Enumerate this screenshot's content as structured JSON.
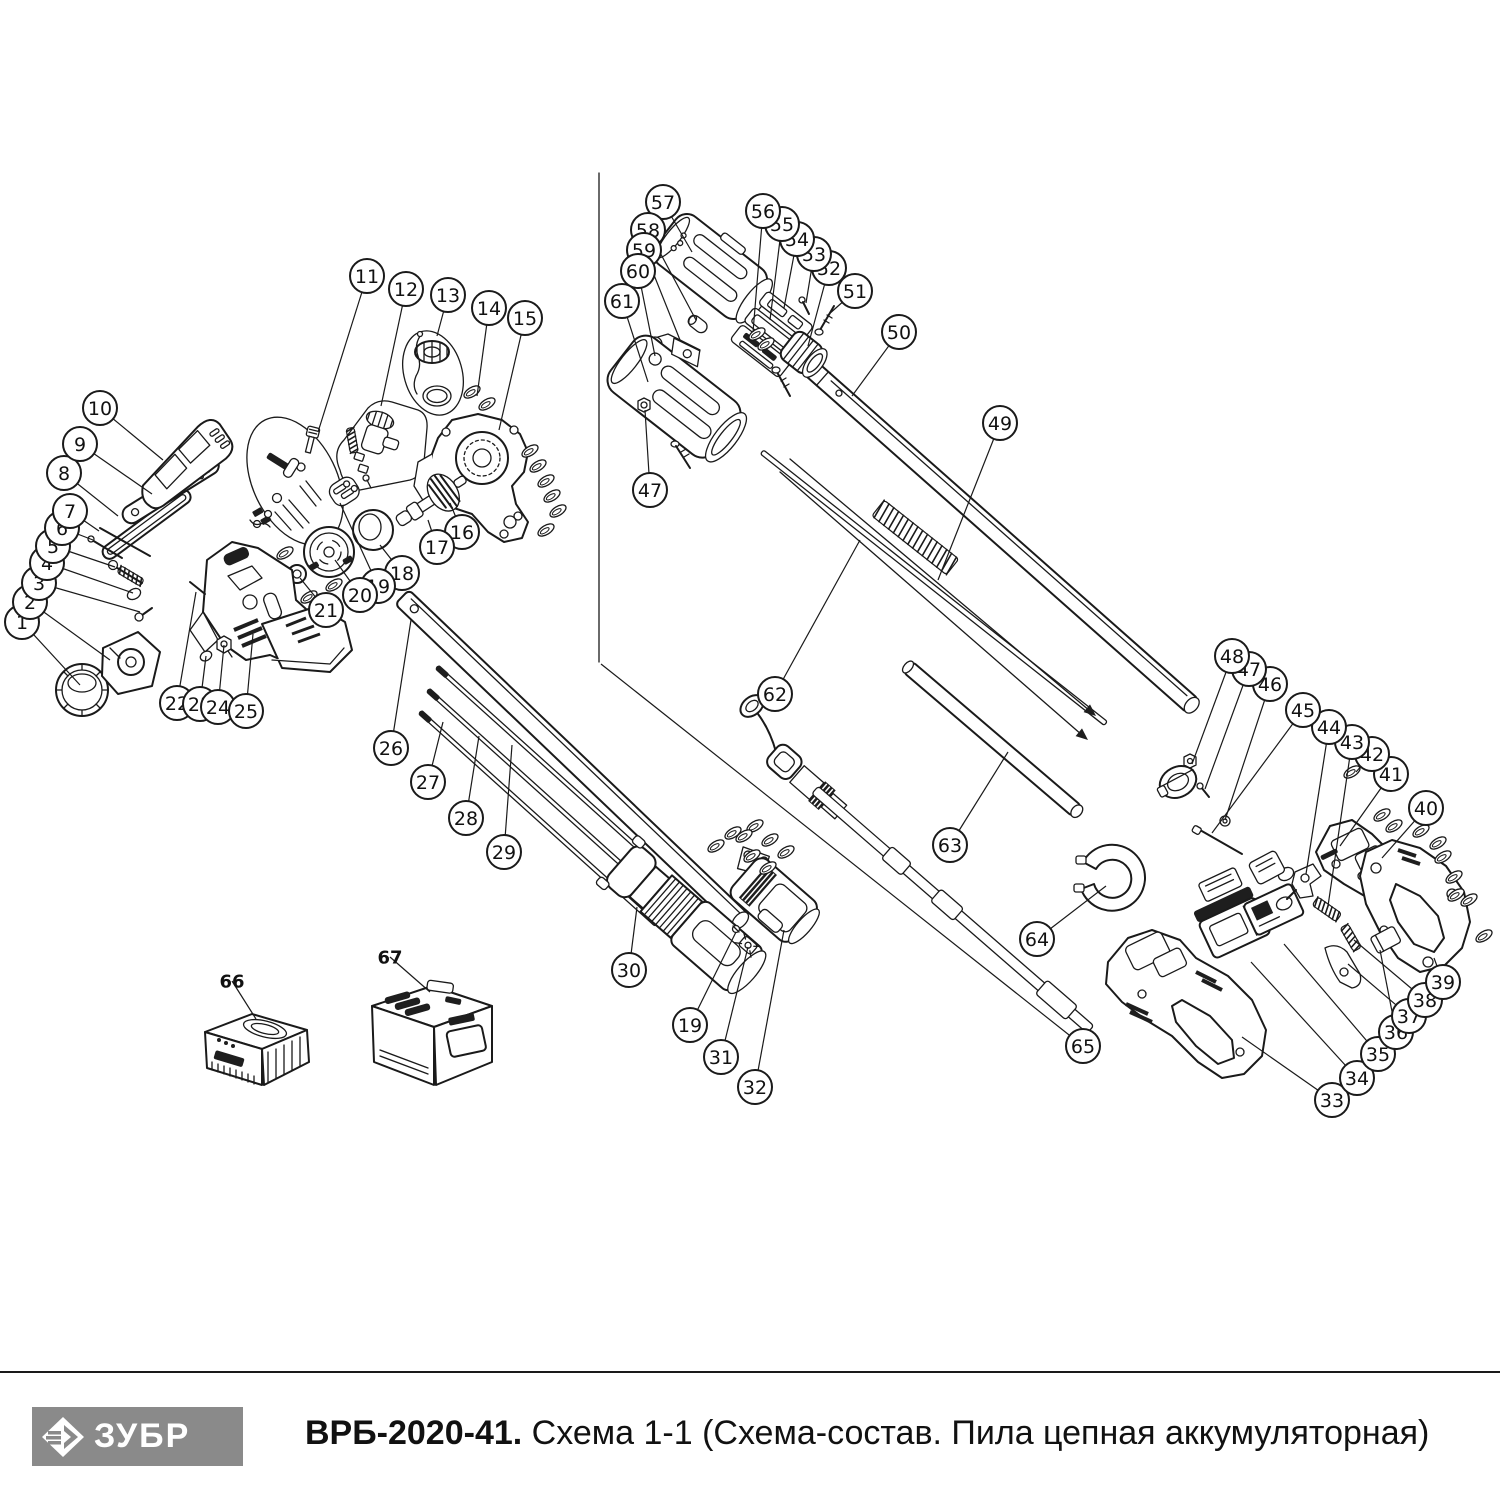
{
  "footer": {
    "logo_text": "ЗУБР",
    "model": "ВРБ-2020-41.",
    "scheme": " Схема 1-1 (Схема-состав. Пила цепная аккумуляторная)"
  },
  "colors": {
    "line": "#1a1a1a",
    "logo_bg": "#8a8a8a",
    "dark_fill": "#1e1e1e",
    "paper": "#ffffff"
  },
  "callouts": [
    {
      "n": "1",
      "x": 22,
      "y": 622,
      "tx": 80,
      "ty": 685
    },
    {
      "n": "2",
      "x": 30,
      "y": 602,
      "tx": 110,
      "ty": 660
    },
    {
      "n": "3",
      "x": 39,
      "y": 583,
      "tx": 140,
      "ty": 612
    },
    {
      "n": "4",
      "x": 47,
      "y": 563,
      "tx": 133,
      "ty": 593
    },
    {
      "n": "5",
      "x": 53,
      "y": 546,
      "tx": 115,
      "ty": 567
    },
    {
      "n": "6",
      "x": 62,
      "y": 528,
      "tx": 93,
      "ty": 540
    },
    {
      "n": "7",
      "x": 70,
      "y": 511,
      "tx": 99,
      "ty": 531
    },
    {
      "n": "8",
      "x": 64,
      "y": 473,
      "tx": 118,
      "ty": 516
    },
    {
      "n": "9",
      "x": 80,
      "y": 444,
      "tx": 152,
      "ty": 494
    },
    {
      "n": "10",
      "x": 100,
      "y": 408,
      "tx": 163,
      "ty": 460
    },
    {
      "n": "11",
      "x": 367,
      "y": 276,
      "tx": 318,
      "ty": 432
    },
    {
      "n": "12",
      "x": 406,
      "y": 289,
      "tx": 381,
      "ty": 406
    },
    {
      "n": "13",
      "x": 448,
      "y": 295,
      "tx": 437,
      "ty": 336
    },
    {
      "n": "14",
      "x": 489,
      "y": 308,
      "tx": 477,
      "ty": 396
    },
    {
      "n": "15",
      "x": 525,
      "y": 318,
      "tx": 499,
      "ty": 430
    },
    {
      "n": "16",
      "x": 462,
      "y": 532,
      "tx": 450,
      "ty": 503
    },
    {
      "n": "17",
      "x": 437,
      "y": 547,
      "tx": 428,
      "ty": 520
    },
    {
      "n": "18",
      "x": 402,
      "y": 573,
      "tx": 380,
      "ty": 545
    },
    {
      "n": "19",
      "x": 378,
      "y": 586,
      "tx": 340,
      "ty": 503
    },
    {
      "n": "20",
      "x": 360,
      "y": 595,
      "tx": 335,
      "ty": 560
    },
    {
      "n": "21",
      "x": 326,
      "y": 610,
      "tx": 300,
      "ty": 578
    },
    {
      "n": "22",
      "x": 177,
      "y": 703,
      "tx": 196,
      "ty": 592
    },
    {
      "n": "23",
      "x": 200,
      "y": 704,
      "tx": 206,
      "ty": 656
    },
    {
      "n": "24",
      "x": 218,
      "y": 707,
      "tx": 224,
      "ty": 645
    },
    {
      "n": "25",
      "x": 246,
      "y": 711,
      "tx": 253,
      "ty": 634
    },
    {
      "n": "26",
      "x": 391,
      "y": 748,
      "tx": 411,
      "ty": 620
    },
    {
      "n": "27",
      "x": 428,
      "y": 782,
      "tx": 443,
      "ty": 722
    },
    {
      "n": "28",
      "x": 466,
      "y": 818,
      "tx": 479,
      "ty": 736
    },
    {
      "n": "29",
      "x": 504,
      "y": 852,
      "tx": 512,
      "ty": 745
    },
    {
      "n": "30",
      "x": 629,
      "y": 970,
      "tx": 637,
      "ty": 907
    },
    {
      "n": "19",
      "x": 690,
      "y": 1025,
      "tx": 736,
      "ty": 932
    },
    {
      "n": "31",
      "x": 721,
      "y": 1057,
      "tx": 748,
      "ty": 947
    },
    {
      "n": "32",
      "x": 755,
      "y": 1087,
      "tx": 784,
      "ty": 930
    },
    {
      "n": "33",
      "x": 1332,
      "y": 1100,
      "tx": 1242,
      "ty": 1037
    },
    {
      "n": "34",
      "x": 1357,
      "y": 1078,
      "tx": 1251,
      "ty": 962
    },
    {
      "n": "35",
      "x": 1378,
      "y": 1054,
      "tx": 1284,
      "ty": 944
    },
    {
      "n": "36",
      "x": 1396,
      "y": 1032,
      "tx": 1380,
      "ty": 950
    },
    {
      "n": "37",
      "x": 1409,
      "y": 1016,
      "tx": 1348,
      "ty": 964
    },
    {
      "n": "38",
      "x": 1425,
      "y": 1000,
      "tx": 1354,
      "ty": 940
    },
    {
      "n": "39",
      "x": 1443,
      "y": 982,
      "tx": 1434,
      "ty": 958
    },
    {
      "n": "40",
      "x": 1426,
      "y": 808,
      "tx": 1382,
      "ty": 858
    },
    {
      "n": "41",
      "x": 1391,
      "y": 774,
      "tx": 1340,
      "ty": 846
    },
    {
      "n": "42",
      "x": 1372,
      "y": 754,
      "tx": 1356,
      "ty": 772
    },
    {
      "n": "43",
      "x": 1352,
      "y": 742,
      "tx": 1328,
      "ty": 906
    },
    {
      "n": "44",
      "x": 1329,
      "y": 727,
      "tx": 1306,
      "ty": 874
    },
    {
      "n": "45",
      "x": 1303,
      "y": 710,
      "tx": 1212,
      "ty": 833
    },
    {
      "n": "46",
      "x": 1270,
      "y": 684,
      "tx": 1225,
      "ty": 820
    },
    {
      "n": "47",
      "x": 1249,
      "y": 669,
      "tx": 1205,
      "ty": 789
    },
    {
      "n": "48",
      "x": 1232,
      "y": 656,
      "tx": 1192,
      "ty": 764
    },
    {
      "n": "49",
      "x": 1000,
      "y": 423,
      "tx": 938,
      "ty": 580
    },
    {
      "n": "50",
      "x": 899,
      "y": 332,
      "tx": 852,
      "ty": 396
    },
    {
      "n": "51",
      "x": 855,
      "y": 291,
      "tx": 828,
      "ty": 315
    },
    {
      "n": "52",
      "x": 829,
      "y": 268,
      "tx": 808,
      "ty": 346
    },
    {
      "n": "53",
      "x": 814,
      "y": 254,
      "tx": 806,
      "ty": 303
    },
    {
      "n": "54",
      "x": 797,
      "y": 239,
      "tx": 784,
      "ty": 308
    },
    {
      "n": "55",
      "x": 782,
      "y": 224,
      "tx": 770,
      "ty": 320
    },
    {
      "n": "56",
      "x": 763,
      "y": 211,
      "tx": 753,
      "ty": 332
    },
    {
      "n": "57",
      "x": 663,
      "y": 202,
      "tx": 692,
      "ty": 252
    },
    {
      "n": "58",
      "x": 648,
      "y": 230,
      "tx": 696,
      "ty": 320
    },
    {
      "n": "59",
      "x": 644,
      "y": 250,
      "tx": 680,
      "ty": 340
    },
    {
      "n": "60",
      "x": 638,
      "y": 271,
      "tx": 655,
      "ty": 356
    },
    {
      "n": "61",
      "x": 622,
      "y": 301,
      "tx": 648,
      "ty": 382
    },
    {
      "n": "47",
      "x": 650,
      "y": 490,
      "tx": 645,
      "ty": 410
    },
    {
      "n": "62",
      "x": 775,
      "y": 694,
      "tx": 860,
      "ty": 540
    },
    {
      "n": "63",
      "x": 950,
      "y": 845,
      "tx": 1008,
      "ty": 752
    },
    {
      "n": "64",
      "x": 1037,
      "y": 939,
      "tx": 1106,
      "ty": 886
    },
    {
      "n": "65",
      "x": 1083,
      "y": 1046,
      "tx": 601,
      "ty": 664
    }
  ],
  "part_labels": [
    {
      "n": "66",
      "x": 232,
      "y": 981,
      "tx": 256,
      "ty": 1019
    },
    {
      "n": "67",
      "x": 390,
      "y": 957,
      "tx": 430,
      "ty": 992
    }
  ]
}
